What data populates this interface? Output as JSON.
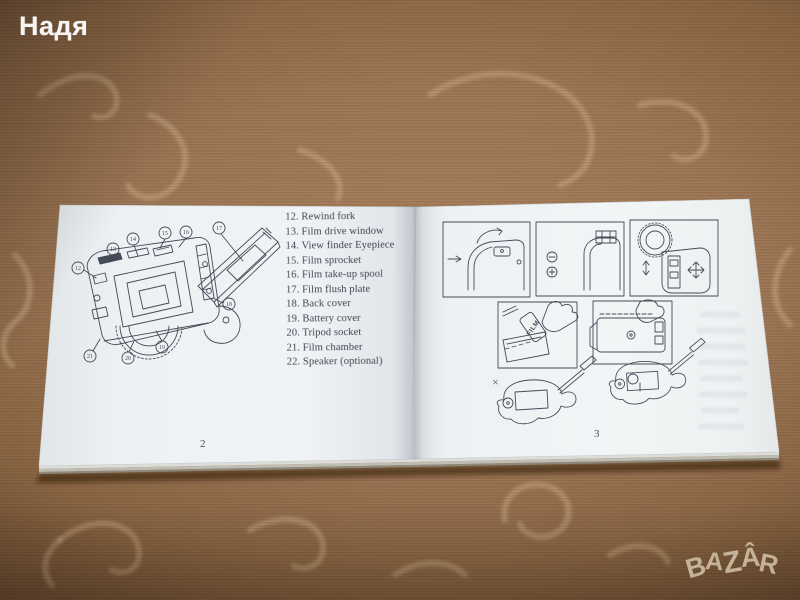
{
  "watermarks": {
    "seller_name": "Надя",
    "logo_letters": [
      "B",
      "A",
      "Z",
      "Â",
      "R"
    ]
  },
  "booklet": {
    "left_page": {
      "page_number": "2",
      "parts_list": [
        "12. Rewind fork",
        "13. Film drive window",
        "14. View finder Eyepiece",
        "15. Film sprocket",
        "16. Film take-up spool",
        "17. Film flush plate",
        "18. Back cover",
        "19. Battery cover",
        "20. Tripod socket",
        "21. Film chamber",
        "22. Speaker (optional)"
      ],
      "diagram_callouts": [
        "12",
        "13",
        "14",
        "15",
        "16",
        "17",
        "18",
        "19",
        "20",
        "21"
      ]
    },
    "right_page": {
      "page_number": "3",
      "film_label": "FILM",
      "wrong_mark": "×"
    }
  },
  "colors": {
    "tablecloth_brown": "#9c7655",
    "page_paper": "#eef2f3",
    "ink": "#454b59",
    "seller_watermark": "#fbfbfb",
    "logo_watermark": "#cdbda4"
  }
}
